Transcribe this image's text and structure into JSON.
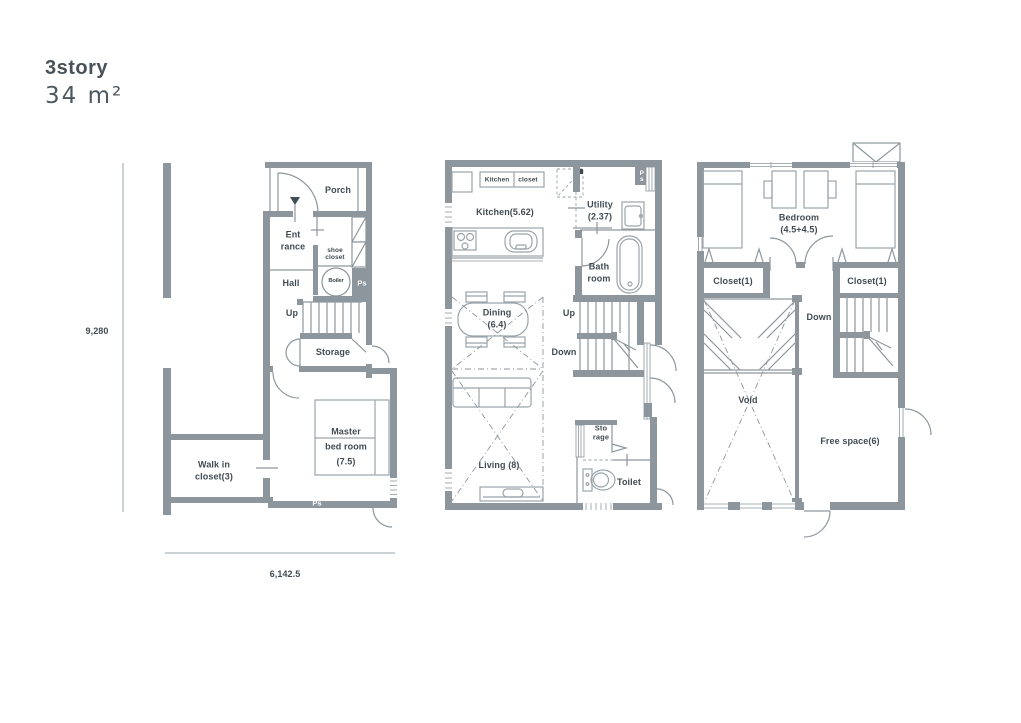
{
  "header": {
    "title": "3story",
    "area": "34 m²"
  },
  "dimensions": {
    "height": "9,280",
    "width": "6,142.5"
  },
  "floor1": {
    "porch": "Porch",
    "entrance": "Ent\nrance",
    "shoe_closet": "shoe\ncloset",
    "hall": "Hall",
    "boiler": "Boiler",
    "ps_top": "Ps",
    "up": "Up",
    "storage": "Storage",
    "walk_in_closet": "Walk in\ncloset(3)",
    "master_bedroom": "Master\nbed room\n(7.5)",
    "ps_bottom": "Ps"
  },
  "floor2": {
    "kitchen_closet_left": "Kitchen",
    "kitchen_closet_right": "closet",
    "kitchen": "Kitchen(5.62)",
    "utility": "Utility\n(2.37)",
    "ps": "Ps",
    "bathroom": "Bath\nroom",
    "dining": "Dining\n(6.4)",
    "up": "Up",
    "down": "Down",
    "storage": "Sto\nrage",
    "living": "Living (8)",
    "toilet": "Toilet"
  },
  "floor3": {
    "bedroom": "Bedroom\n(4.5+4.5)",
    "closet_left": "Closet(1)",
    "closet_right": "Closet(1)",
    "down": "Down",
    "void": "Void",
    "free_space": "Free space(6)"
  },
  "colors": {
    "wall": "#8d969c",
    "text": "#414b52",
    "furniture": "#9aa3a9",
    "background": "#ffffff"
  }
}
